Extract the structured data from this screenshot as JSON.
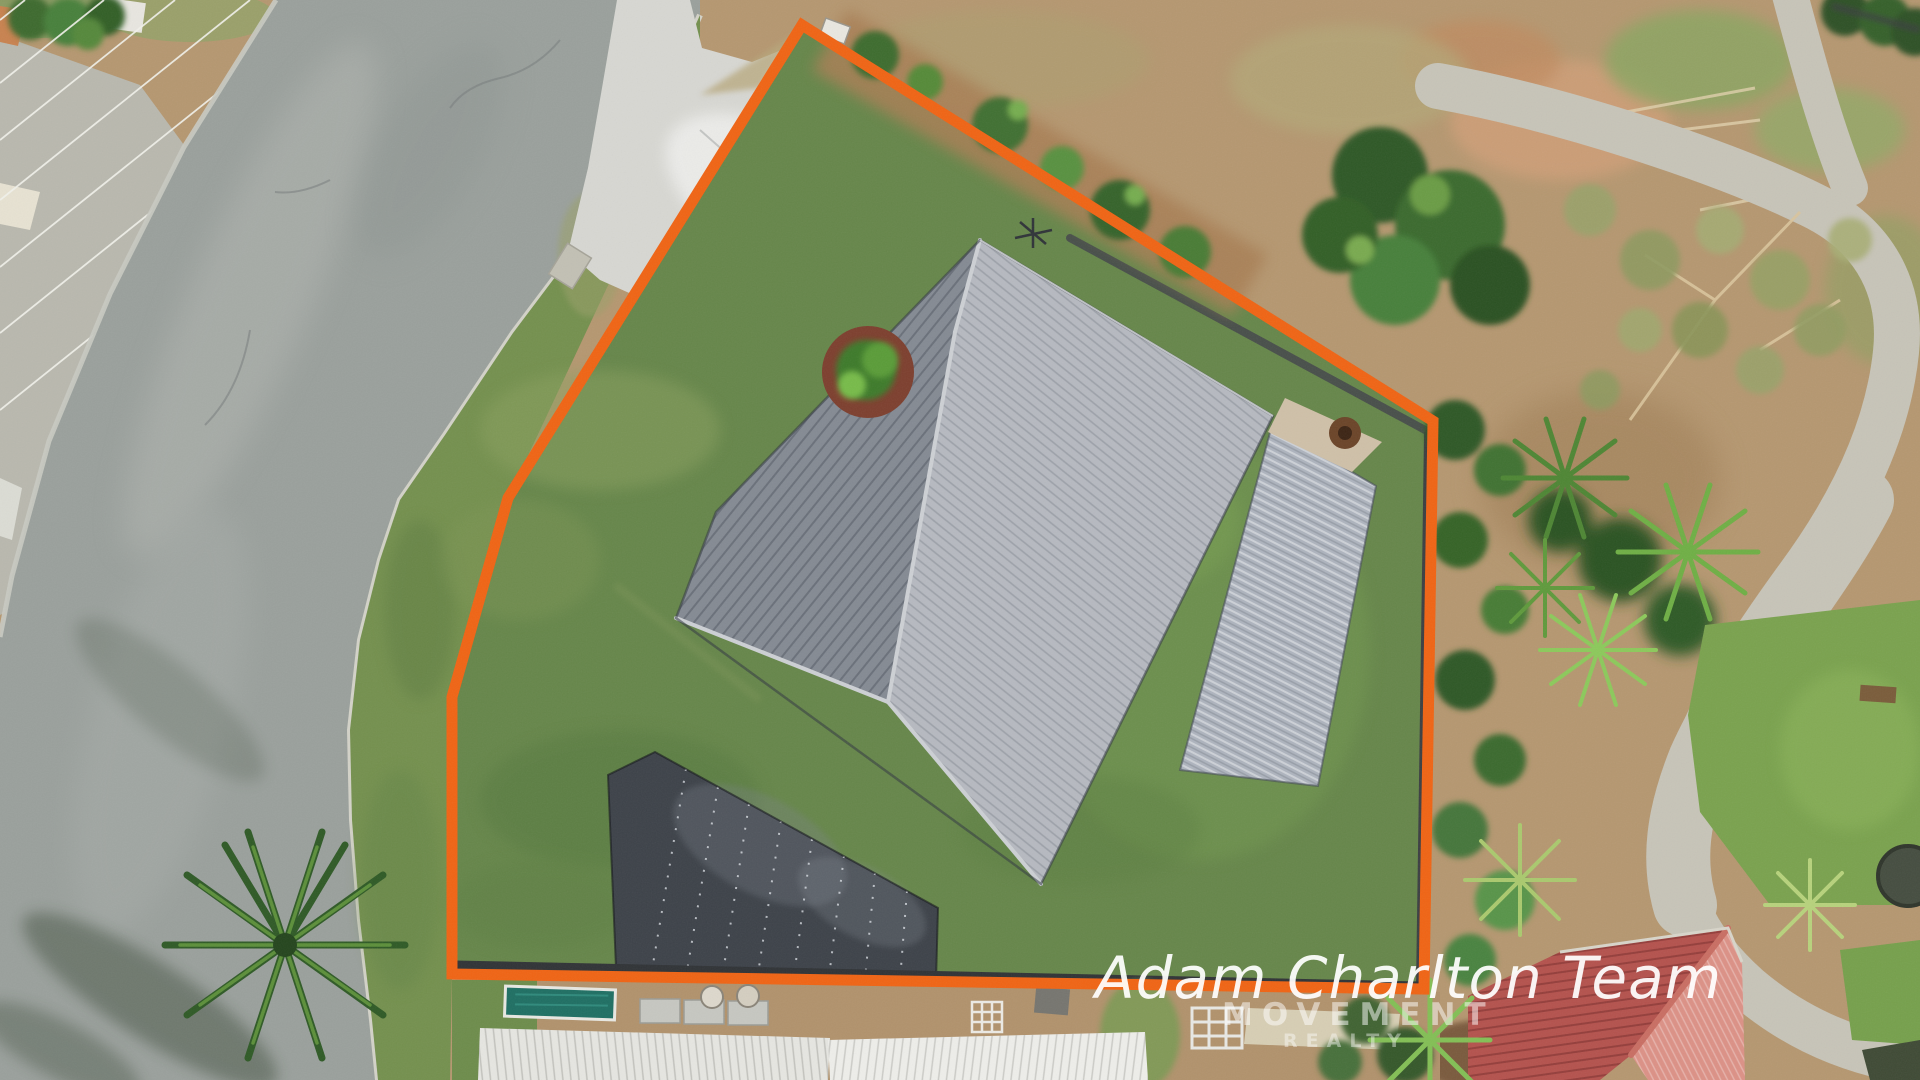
{
  "watermark": {
    "team": "Adam Charlton Team",
    "team_color": "rgba(255,255,255,0.93)",
    "brand": "MOVEMENT",
    "brand_color": "rgba(255,255,255,0.50)",
    "brand_sub": "REALTY",
    "brand_sub_color": "rgba(255,255,255,0.42)"
  },
  "boundary": {
    "color": "#F06414",
    "points": "802,25 1433,421 1424,989 452,974 452,697 508,498 802,25",
    "stroke_width": "11"
  }
}
